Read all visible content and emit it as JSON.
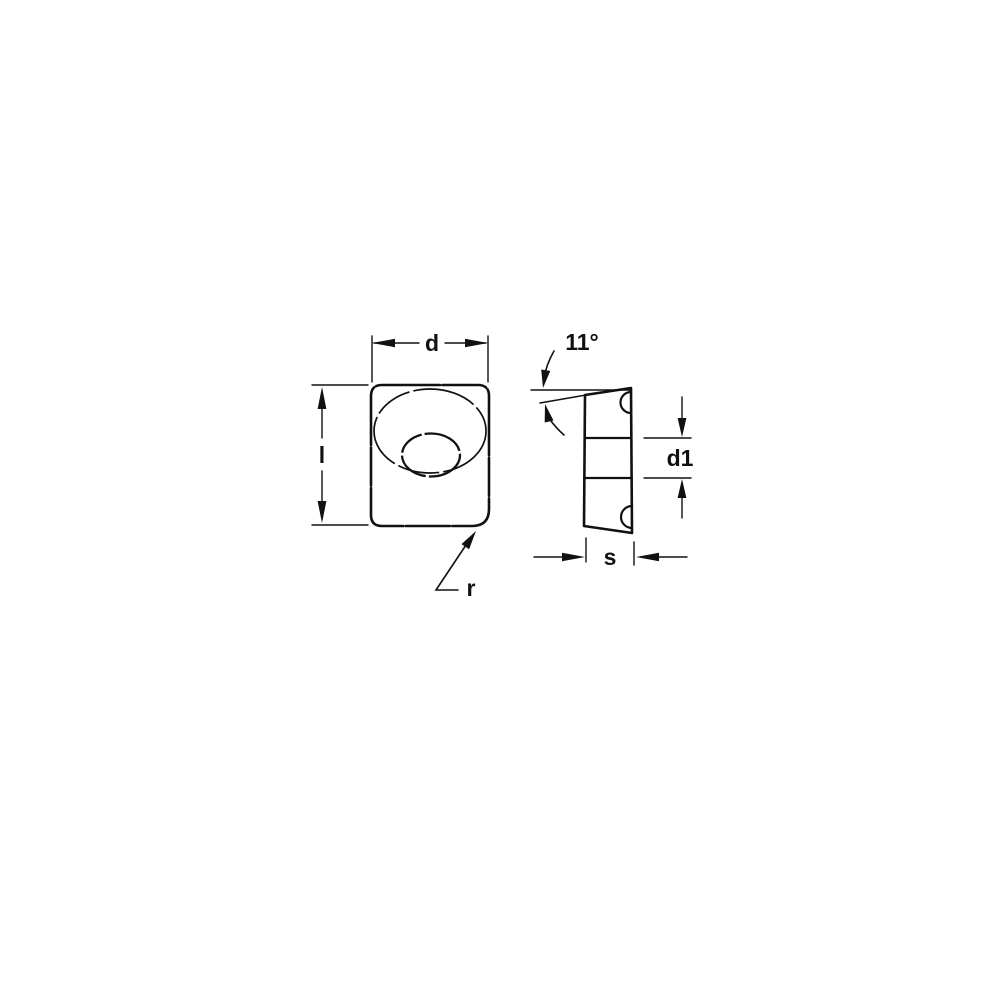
{
  "figure": {
    "background": "#ffffff",
    "ink": "#111111",
    "front_view": {
      "dim_width_label": "d",
      "dim_length_label": "l",
      "corner_radius_label": "r"
    },
    "side_view": {
      "angle_label": "11°",
      "dim_d1_label": "d1",
      "dim_thickness_label": "s"
    }
  }
}
